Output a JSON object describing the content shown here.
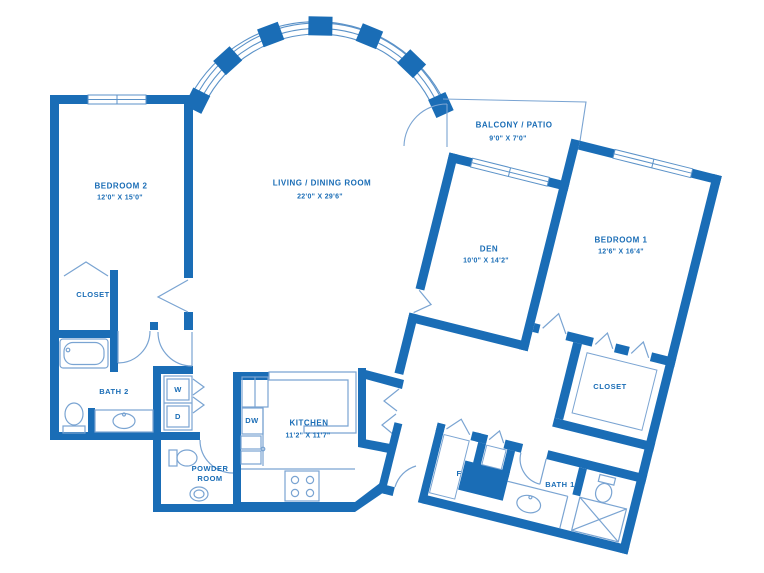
{
  "colors": {
    "wall_blue": "#1a6db6",
    "line_blue": "#7aa4d2",
    "text_blue": "#1a6db6",
    "background": "#ffffff"
  },
  "rooms": {
    "bedroom2": {
      "name": "BEDROOM 2",
      "dims": "12'0\" X 15'0\""
    },
    "closet_bedroom2": {
      "name": "CLOSET"
    },
    "bath2": {
      "name": "BATH 2"
    },
    "powder": {
      "name": "POWDER ROOM"
    },
    "kitchen": {
      "name": "KITCHEN",
      "dims": "11'2\" X 11'7\""
    },
    "living": {
      "name": "LIVING / DINING ROOM",
      "dims": "22'0\" X 29'6\""
    },
    "balcony": {
      "name": "BALCONY / PATIO",
      "dims": "9'0\" X 7'0\""
    },
    "den": {
      "name": "DEN",
      "dims": "10'0\" X 14'2\""
    },
    "bedroom1": {
      "name": "BEDROOM 1",
      "dims": "12'6\" X 16'4\""
    },
    "closet_bedroom1": {
      "name": "CLOSET"
    },
    "bath1": {
      "name": "BATH 1"
    }
  },
  "appliances": {
    "washer": "W",
    "dryer": "D",
    "dishwasher": "DW"
  },
  "closets": {
    "f": "F",
    "l": "L"
  }
}
